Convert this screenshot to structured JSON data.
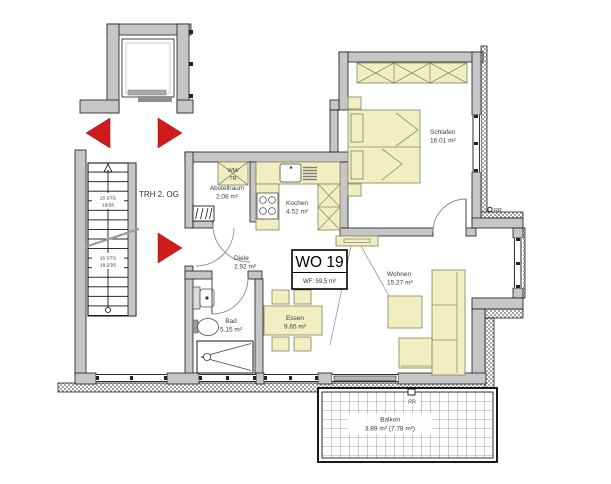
{
  "unit": {
    "label": "WO 19",
    "area": "WF: 59,5 m²"
  },
  "stairwell": {
    "label": "TRH 2. OG",
    "upper_flight": {
      "steps": "15 STG",
      "ratio": "19/26"
    },
    "lower_flight": {
      "steps": "16 STG",
      "ratio": "18,2/26"
    }
  },
  "rooms": {
    "abstellraum": {
      "name": "Abstellraum",
      "area": "2.08 m²"
    },
    "kochen": {
      "name": "Kochen",
      "area": "4.52 m²"
    },
    "schlafen": {
      "name": "Schlafen",
      "area": "16.01 m²"
    },
    "diele": {
      "name": "Diele",
      "area": "2.92 m²"
    },
    "bad": {
      "name": "Bad",
      "area": "5.15 m²"
    },
    "essen": {
      "name": "Essen",
      "area": "9.65 m²"
    },
    "wohnen": {
      "name": "Wohnen",
      "area": "15.27 m²"
    },
    "balkon": {
      "name": "Balkon",
      "area": "3.89 m² (7.78 m²)"
    }
  },
  "appliances": {
    "washer_dryer_line1": "WM/",
    "washer_dryer_line2": "TR"
  },
  "markers": {
    "rr_wall": "RR",
    "rr_balcony": "RR"
  },
  "colors": {
    "wall": "#c6c6c6",
    "furniture": "#f1efc2",
    "furniture_outline": "#8e8e6e",
    "arrow_red": "#cf1b1b",
    "text": "#3c3c3c"
  }
}
